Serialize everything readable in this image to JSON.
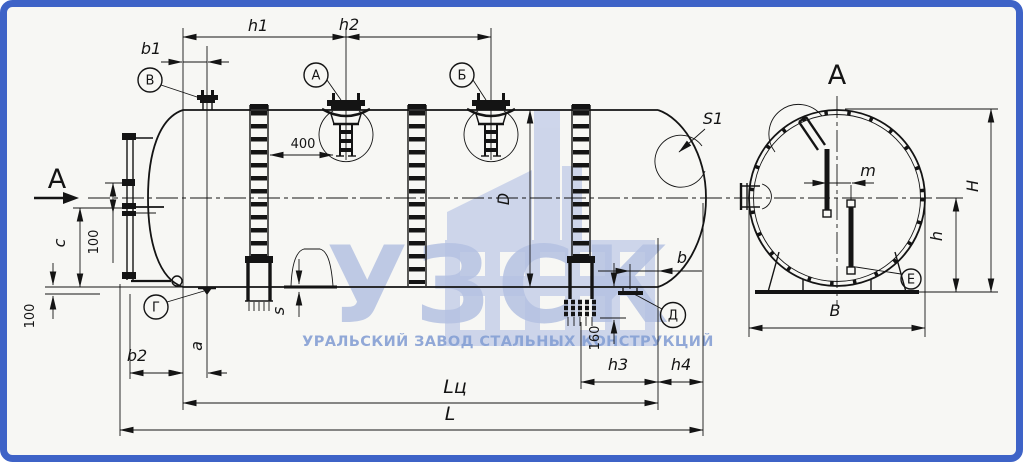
{
  "colors": {
    "frame": "#3e63c7",
    "paper": "#f7f7f4",
    "line": "#141414",
    "watermark_letters": "#b5c2e2",
    "watermark_icon": "#c9d2ea",
    "watermark_tagline": "#86a0d4"
  },
  "watermark": {
    "letters": "УЗСК",
    "tagline": "УРАЛЬСКИЙ ЗАВОД СТАЛЬНЫХ КОНСТРУКЦИЙ",
    "icon": "factory-icon"
  },
  "main_view": {
    "section_arrow_label": "А",
    "callouts": {
      "v": "В",
      "a": "А",
      "b": "Б",
      "g": "Г",
      "d": "Д"
    },
    "dims": {
      "b1": "b1",
      "h1": "h1",
      "h2": "h2",
      "n400": "400",
      "n100_top": "100",
      "c": "c",
      "n100_bottom": "100",
      "b2": "b2",
      "a": "a",
      "s": "s",
      "s1": "S1",
      "d": "D",
      "b": "b",
      "n160": "160",
      "h3": "h3",
      "h4": "h4",
      "l_c": "Lц",
      "l": "L"
    }
  },
  "section_view": {
    "title": "А",
    "callout_e": "Е",
    "dims": {
      "m": "m",
      "h_total": "H",
      "h_low": "h",
      "b_width": "B"
    }
  }
}
